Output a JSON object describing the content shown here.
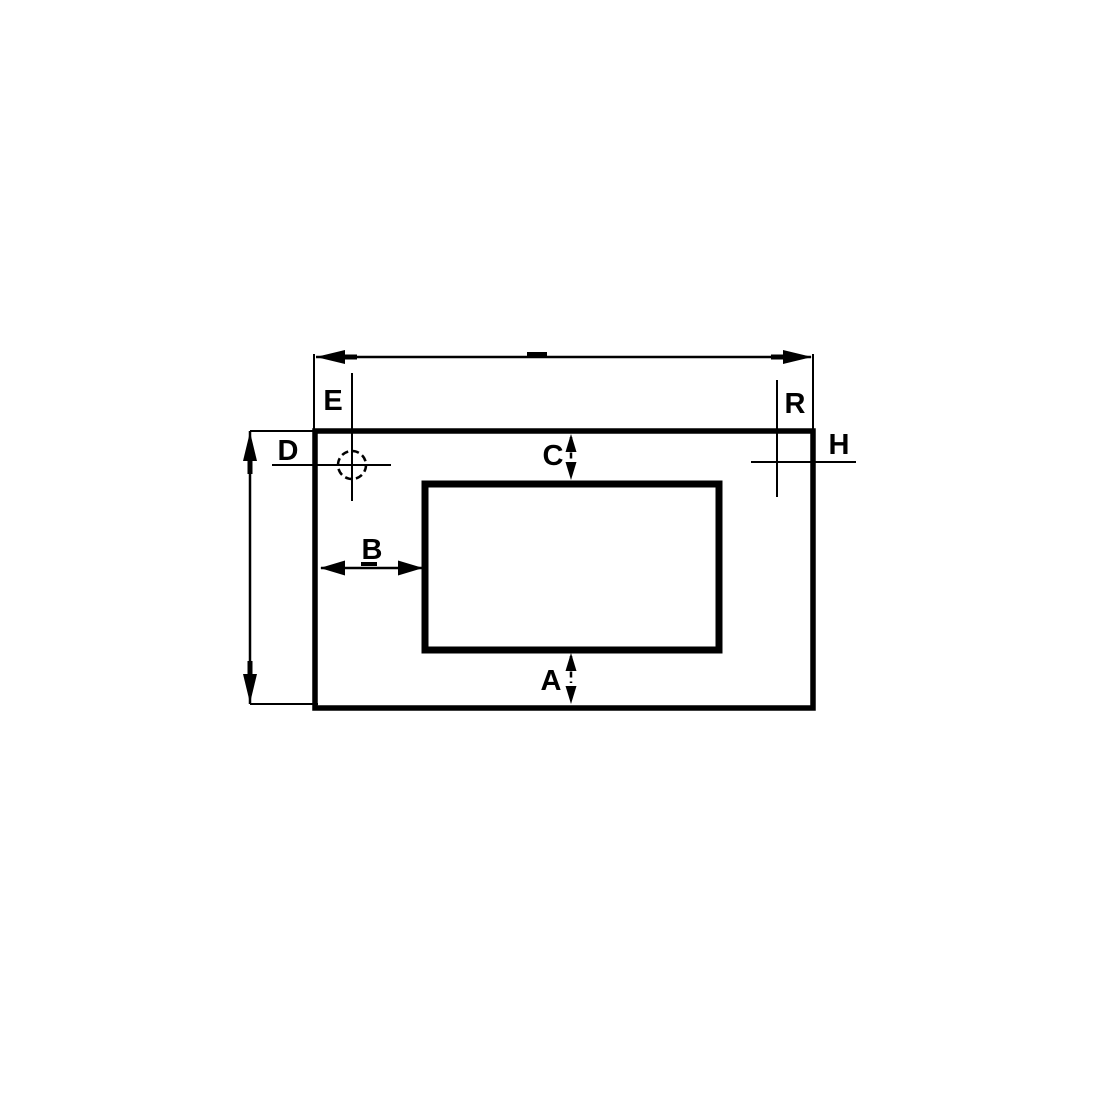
{
  "diagram": {
    "type": "technical-dimension-drawing",
    "background_color": "#ffffff",
    "line_color": "#000000",
    "labels": {
      "a": "A",
      "b": "B",
      "c": "C",
      "d": "D",
      "e": "E",
      "h": "H",
      "r": "R"
    }
  }
}
